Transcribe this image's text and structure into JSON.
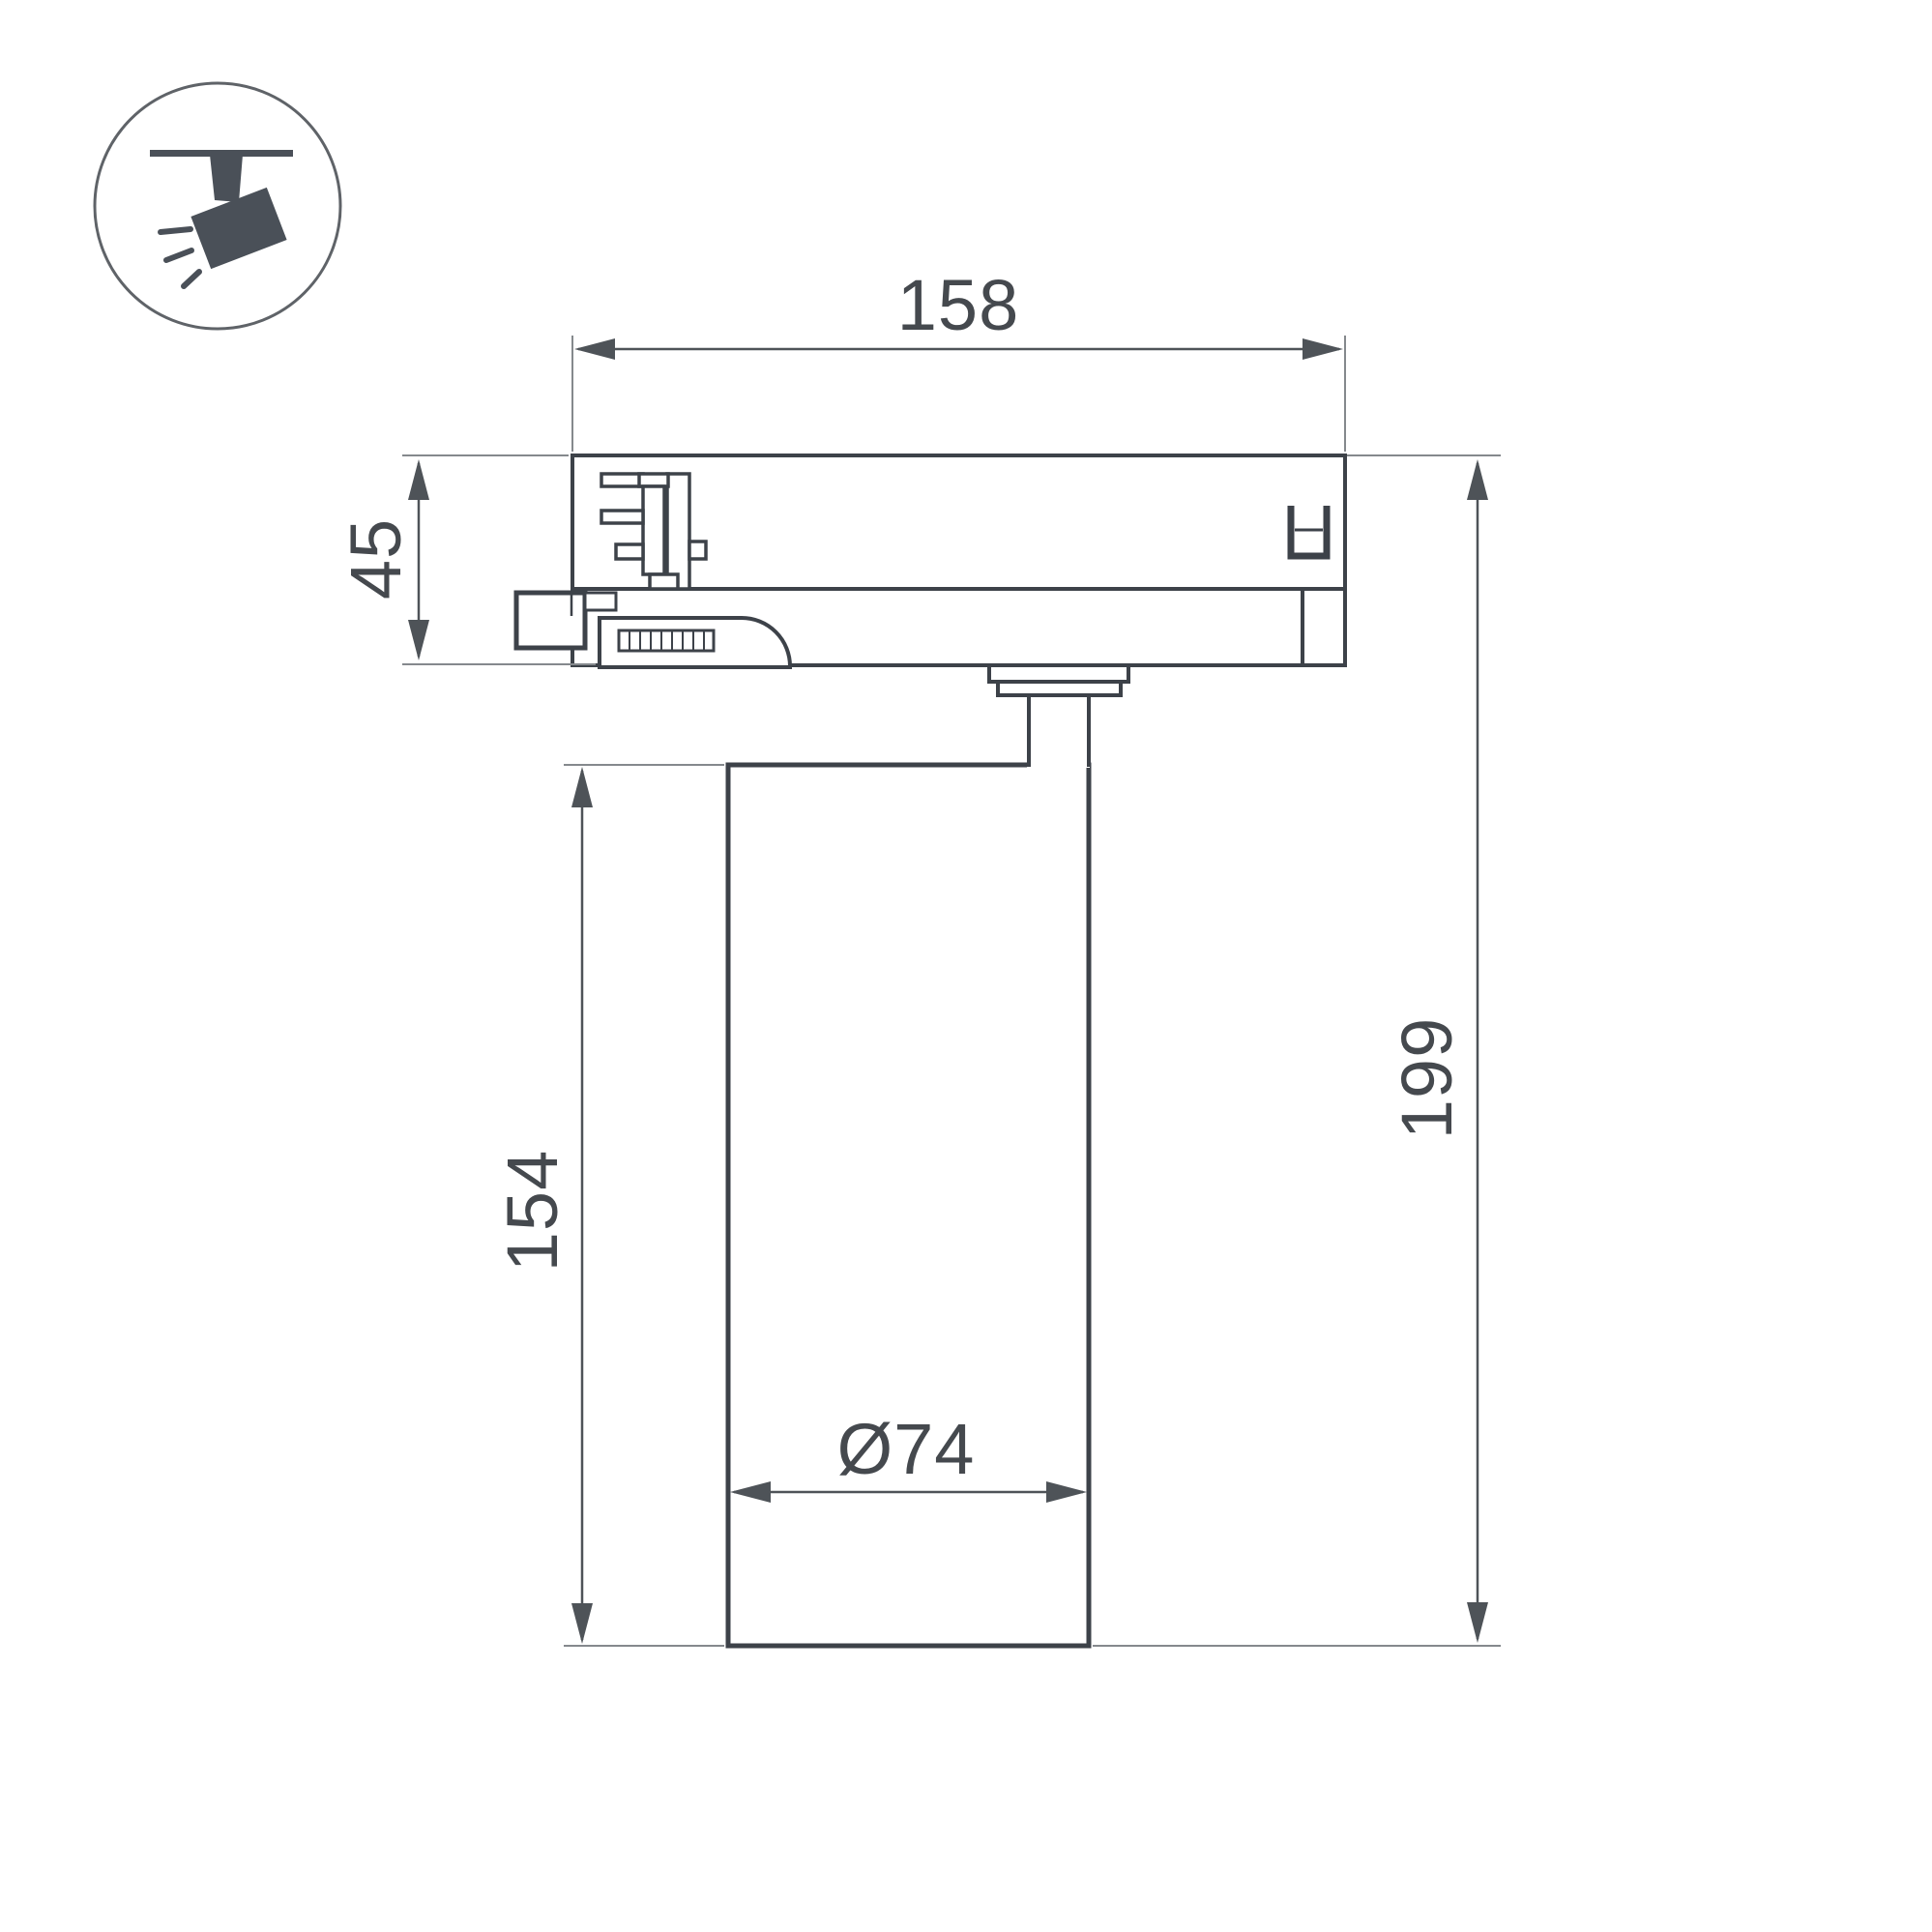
{
  "title": "Track spotlight dimensional drawing",
  "icon": {
    "name": "track-spotlight-icon"
  },
  "labels": {
    "track_width": "158",
    "adapter_height": "45",
    "body_height": "154",
    "total_height": "199",
    "body_diameter": "Ø74"
  },
  "colors": {
    "bg": "#ffffff",
    "outline": "#3d4249",
    "dim": "#4e5358",
    "ext": "#85898d",
    "text": "#45494e",
    "icon": "#4a5058",
    "circle": "#5f6368"
  }
}
